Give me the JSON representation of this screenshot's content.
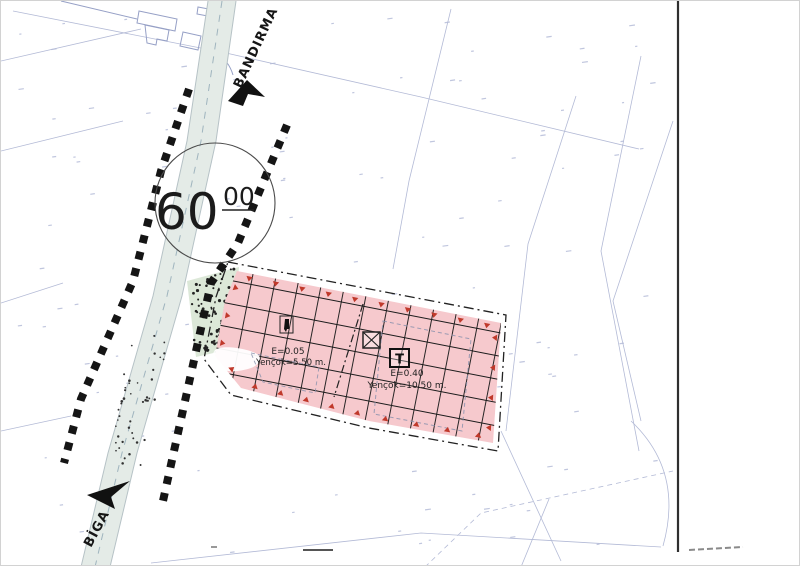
{
  "map": {
    "road": {
      "name_top": "BANDIRMA",
      "name_bottom": "BİGA",
      "width_label": {
        "value": "60",
        "decimals": "00"
      }
    },
    "zones": {
      "left_zone": {
        "emsal_label": "E=0.05",
        "height_label": "Yençok=5.50 m.",
        "symbol_icon": "fountain-icon"
      },
      "commercial_zone": {
        "symbol": "T",
        "emsal_label": "E=0.40",
        "height_label": "Yençok=10.50 m.",
        "transformer_icon": "transformer-icon"
      }
    },
    "colors": {
      "zone_fill": "#f6c9cd",
      "boundary_marker": "#c0392b",
      "road_fill": "#e4ebe7",
      "stipple_fill": "#dce8d8",
      "cadastral_line": "#b3bad6",
      "building_line": "#96a0c6",
      "grid_line": "#1c1c1c",
      "number_noise": "#b9c0da"
    }
  }
}
